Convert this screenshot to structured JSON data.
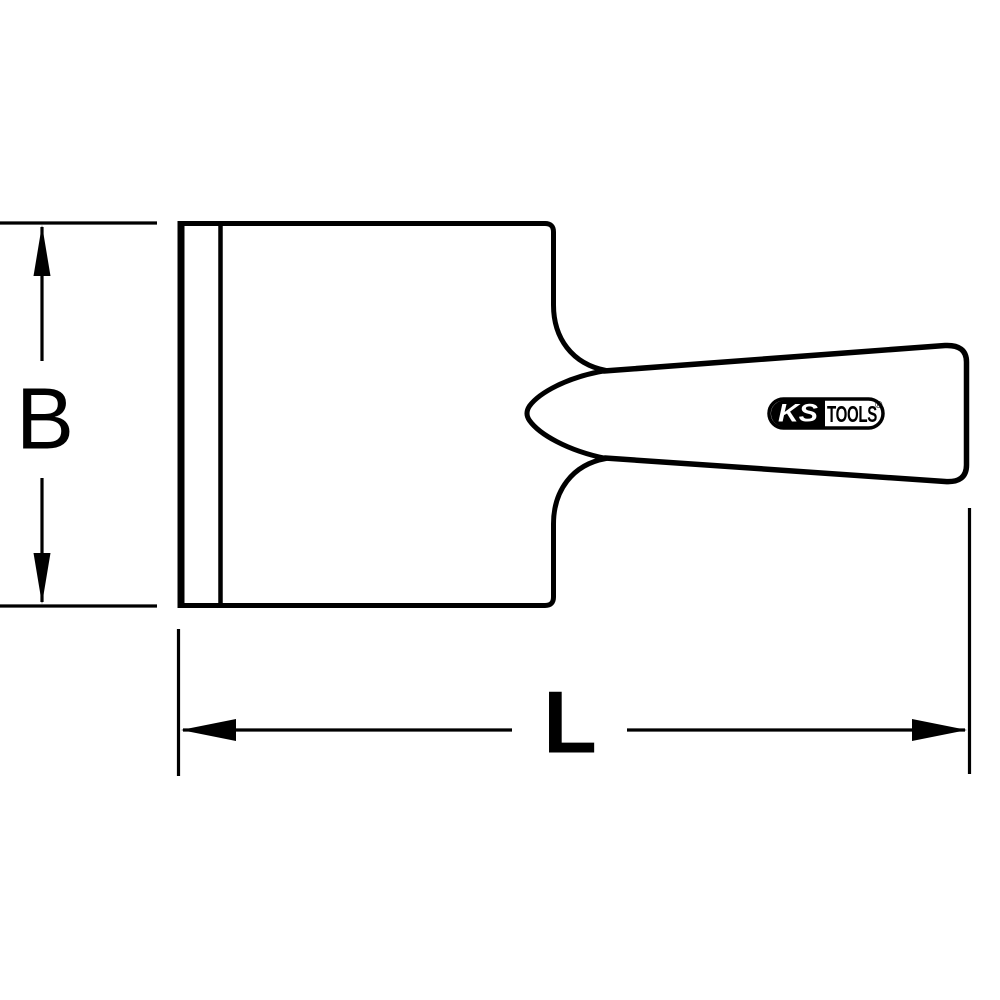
{
  "colors": {
    "line": "#000000",
    "bg": "#ffffff"
  },
  "drawing": {
    "subject": "scraper-technical-drawing",
    "dimensions": {
      "height_label": "B",
      "length_label": "L"
    },
    "logo": {
      "ks": "KS",
      "tools": "TOOLS",
      "registered": "®"
    }
  }
}
